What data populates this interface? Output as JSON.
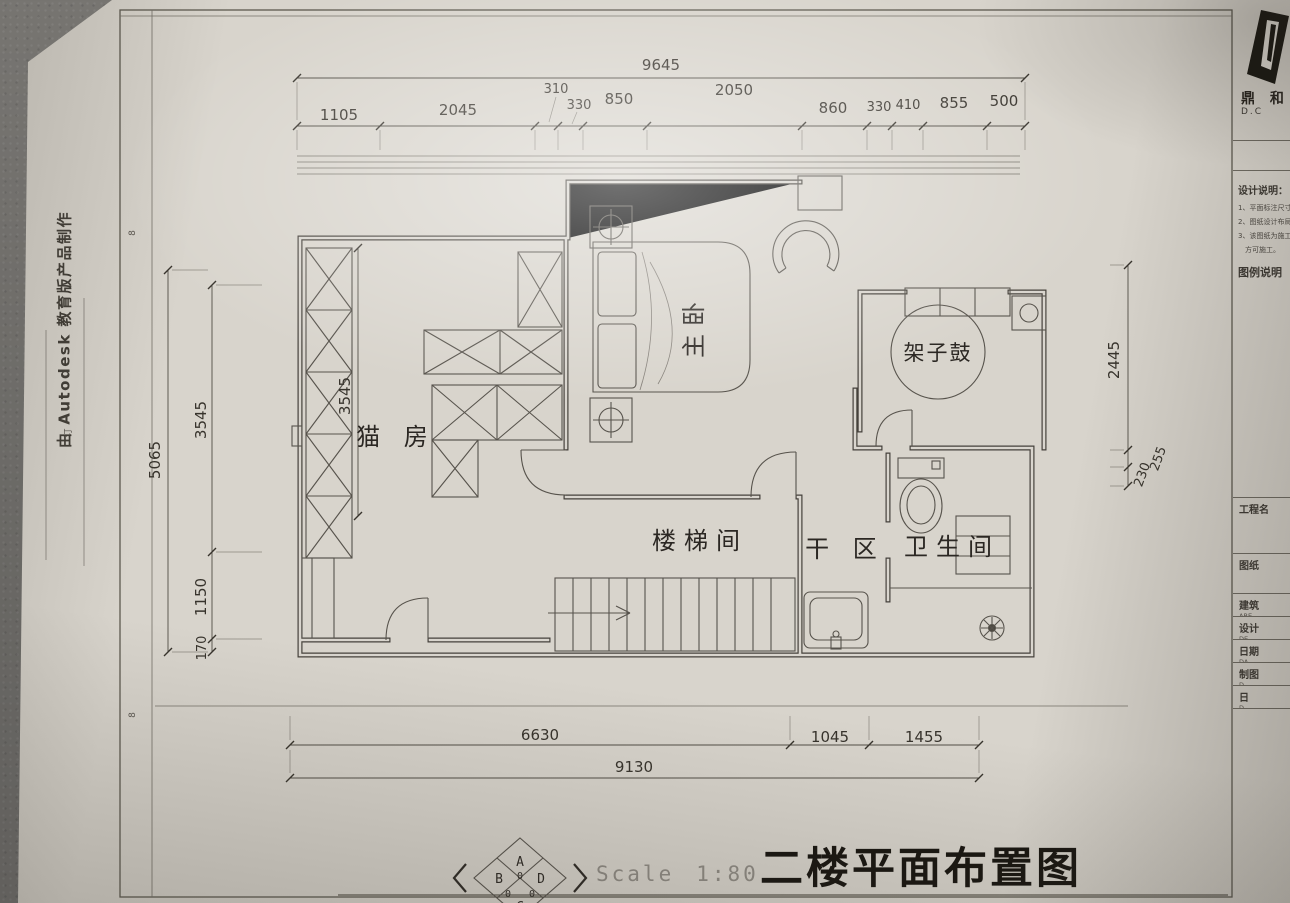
{
  "dims": {
    "top_total": "9645",
    "top_row": [
      "1105",
      "2045",
      "310",
      "330",
      "850",
      "2050",
      "860",
      "330",
      "410",
      "855",
      "500"
    ],
    "left_outer": "5065",
    "left_inner": [
      "3545",
      "1150",
      "170"
    ],
    "room_inner": "3545",
    "right_outer": "2445",
    "right_small": [
      "230",
      "255"
    ],
    "bottom_row": [
      "6630",
      "1045",
      "1455"
    ],
    "bottom_total": "9130"
  },
  "rooms": {
    "master": "主卧",
    "drums": "架子鼓",
    "cat": "猫 房",
    "stair": "楼梯间",
    "dry": "干 区",
    "bath": "卫生间"
  },
  "title_block": {
    "title": "二楼平面布置图",
    "scale_label": "Scale",
    "scale_value": "1:80"
  },
  "stamp": {
    "top": "A",
    "left": "B",
    "right": "D",
    "bottom": "C",
    "zero_top": "0",
    "zero_left": "0",
    "zero_right": "0"
  },
  "margin_note": "由 Autodesk 教育版产品制作",
  "frame_marks": {
    "tick_upper": "8",
    "tick_lower": "8",
    "binding": "订"
  },
  "panel": {
    "logo_cn": "鼎 和",
    "logo_en": "D.C",
    "notes_title": "设计说明：",
    "notes": [
      "1、平面标注尺寸为",
      "2、图纸设计布局遵",
      "3、该图纸为施工图",
      "方可施工。"
    ],
    "legend_title": "图例说明",
    "rows": [
      {
        "cn": "工程名",
        "en": ""
      },
      {
        "cn": "图纸",
        "en": ""
      },
      {
        "cn": "建筑",
        "en": "ARE"
      },
      {
        "cn": "设计",
        "en": "DE"
      },
      {
        "cn": "日期",
        "en": "DA"
      },
      {
        "cn": "制图",
        "en": "D"
      },
      {
        "cn": "日",
        "en": "D"
      }
    ]
  }
}
